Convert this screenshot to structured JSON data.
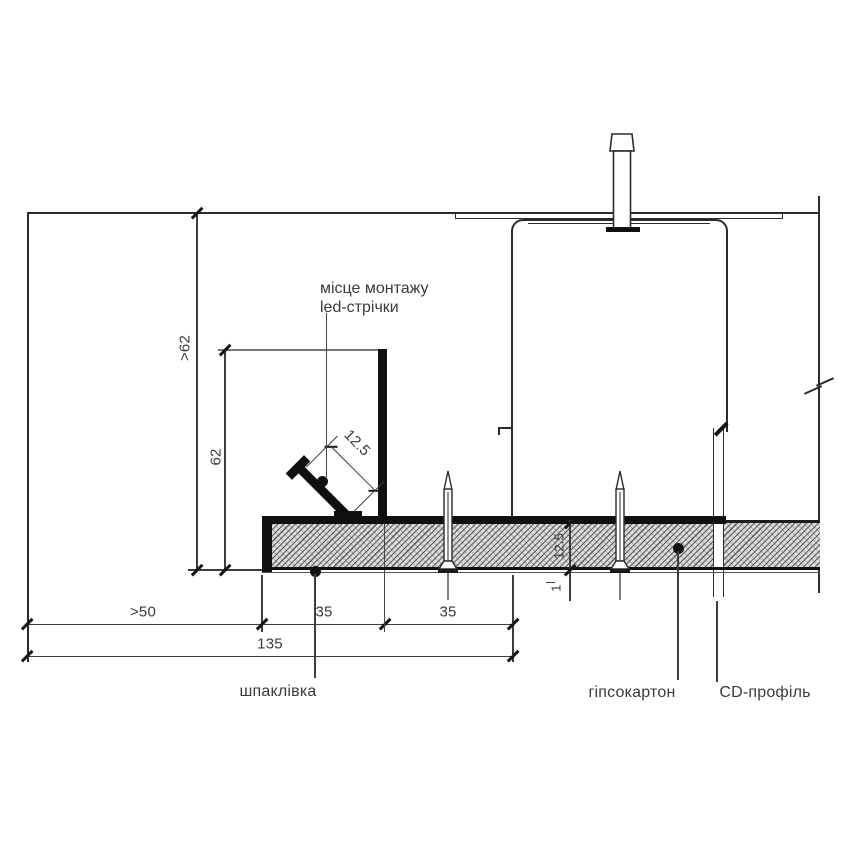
{
  "annotation_led": {
    "line1": "місце монтажу",
    "line2": "led-стрічки"
  },
  "material_labels": {
    "putty": "шпаклівка",
    "drywall": "гіпсокартон",
    "cd_profile": "CD-профіль"
  },
  "dimensions": {
    "drop_total_min": ">62",
    "niche_height": "62",
    "led_channel_width": "12.5",
    "wall_clearance_min": ">50",
    "shelf_width": "35",
    "upstand_to_hanger": "35",
    "niche_total_width": "135",
    "board_thickness": "12.5",
    "putty_layer": "1"
  },
  "colors": {
    "structure_line": "#2b2b2b",
    "dimension_line": "#3d3d3d",
    "solid_fill": "#101010",
    "hatch_background": "#dcdcdc",
    "hatch_line": "#8a8a8a",
    "text": "#3a3a3a"
  }
}
